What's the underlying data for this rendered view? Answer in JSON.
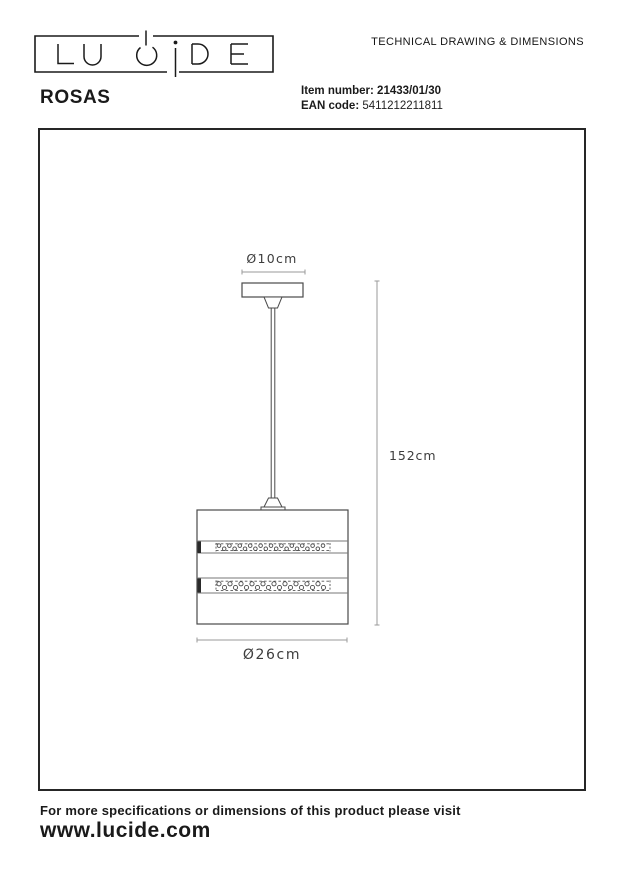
{
  "header": {
    "logo_text": "LUCIDE",
    "doc_title": "TECHNICAL DRAWING & DIMENSIONS"
  },
  "product": {
    "name": "ROSAS",
    "item_number_label": "Item number:",
    "item_number": "21433/01/30",
    "ean_label": "EAN code:",
    "ean_code": "5411212211811"
  },
  "drawing": {
    "canopy_diameter": "Ø10cm",
    "height": "152cm",
    "shade_diameter": "Ø26cm"
  },
  "footer": {
    "note": "For more specifications or dimensions of this product please visit",
    "website": "www.lucide.com"
  },
  "colors": {
    "ink": "#1a1a1a",
    "dim_line": "#9a9a9a",
    "object_line": "#4a4a4a"
  }
}
